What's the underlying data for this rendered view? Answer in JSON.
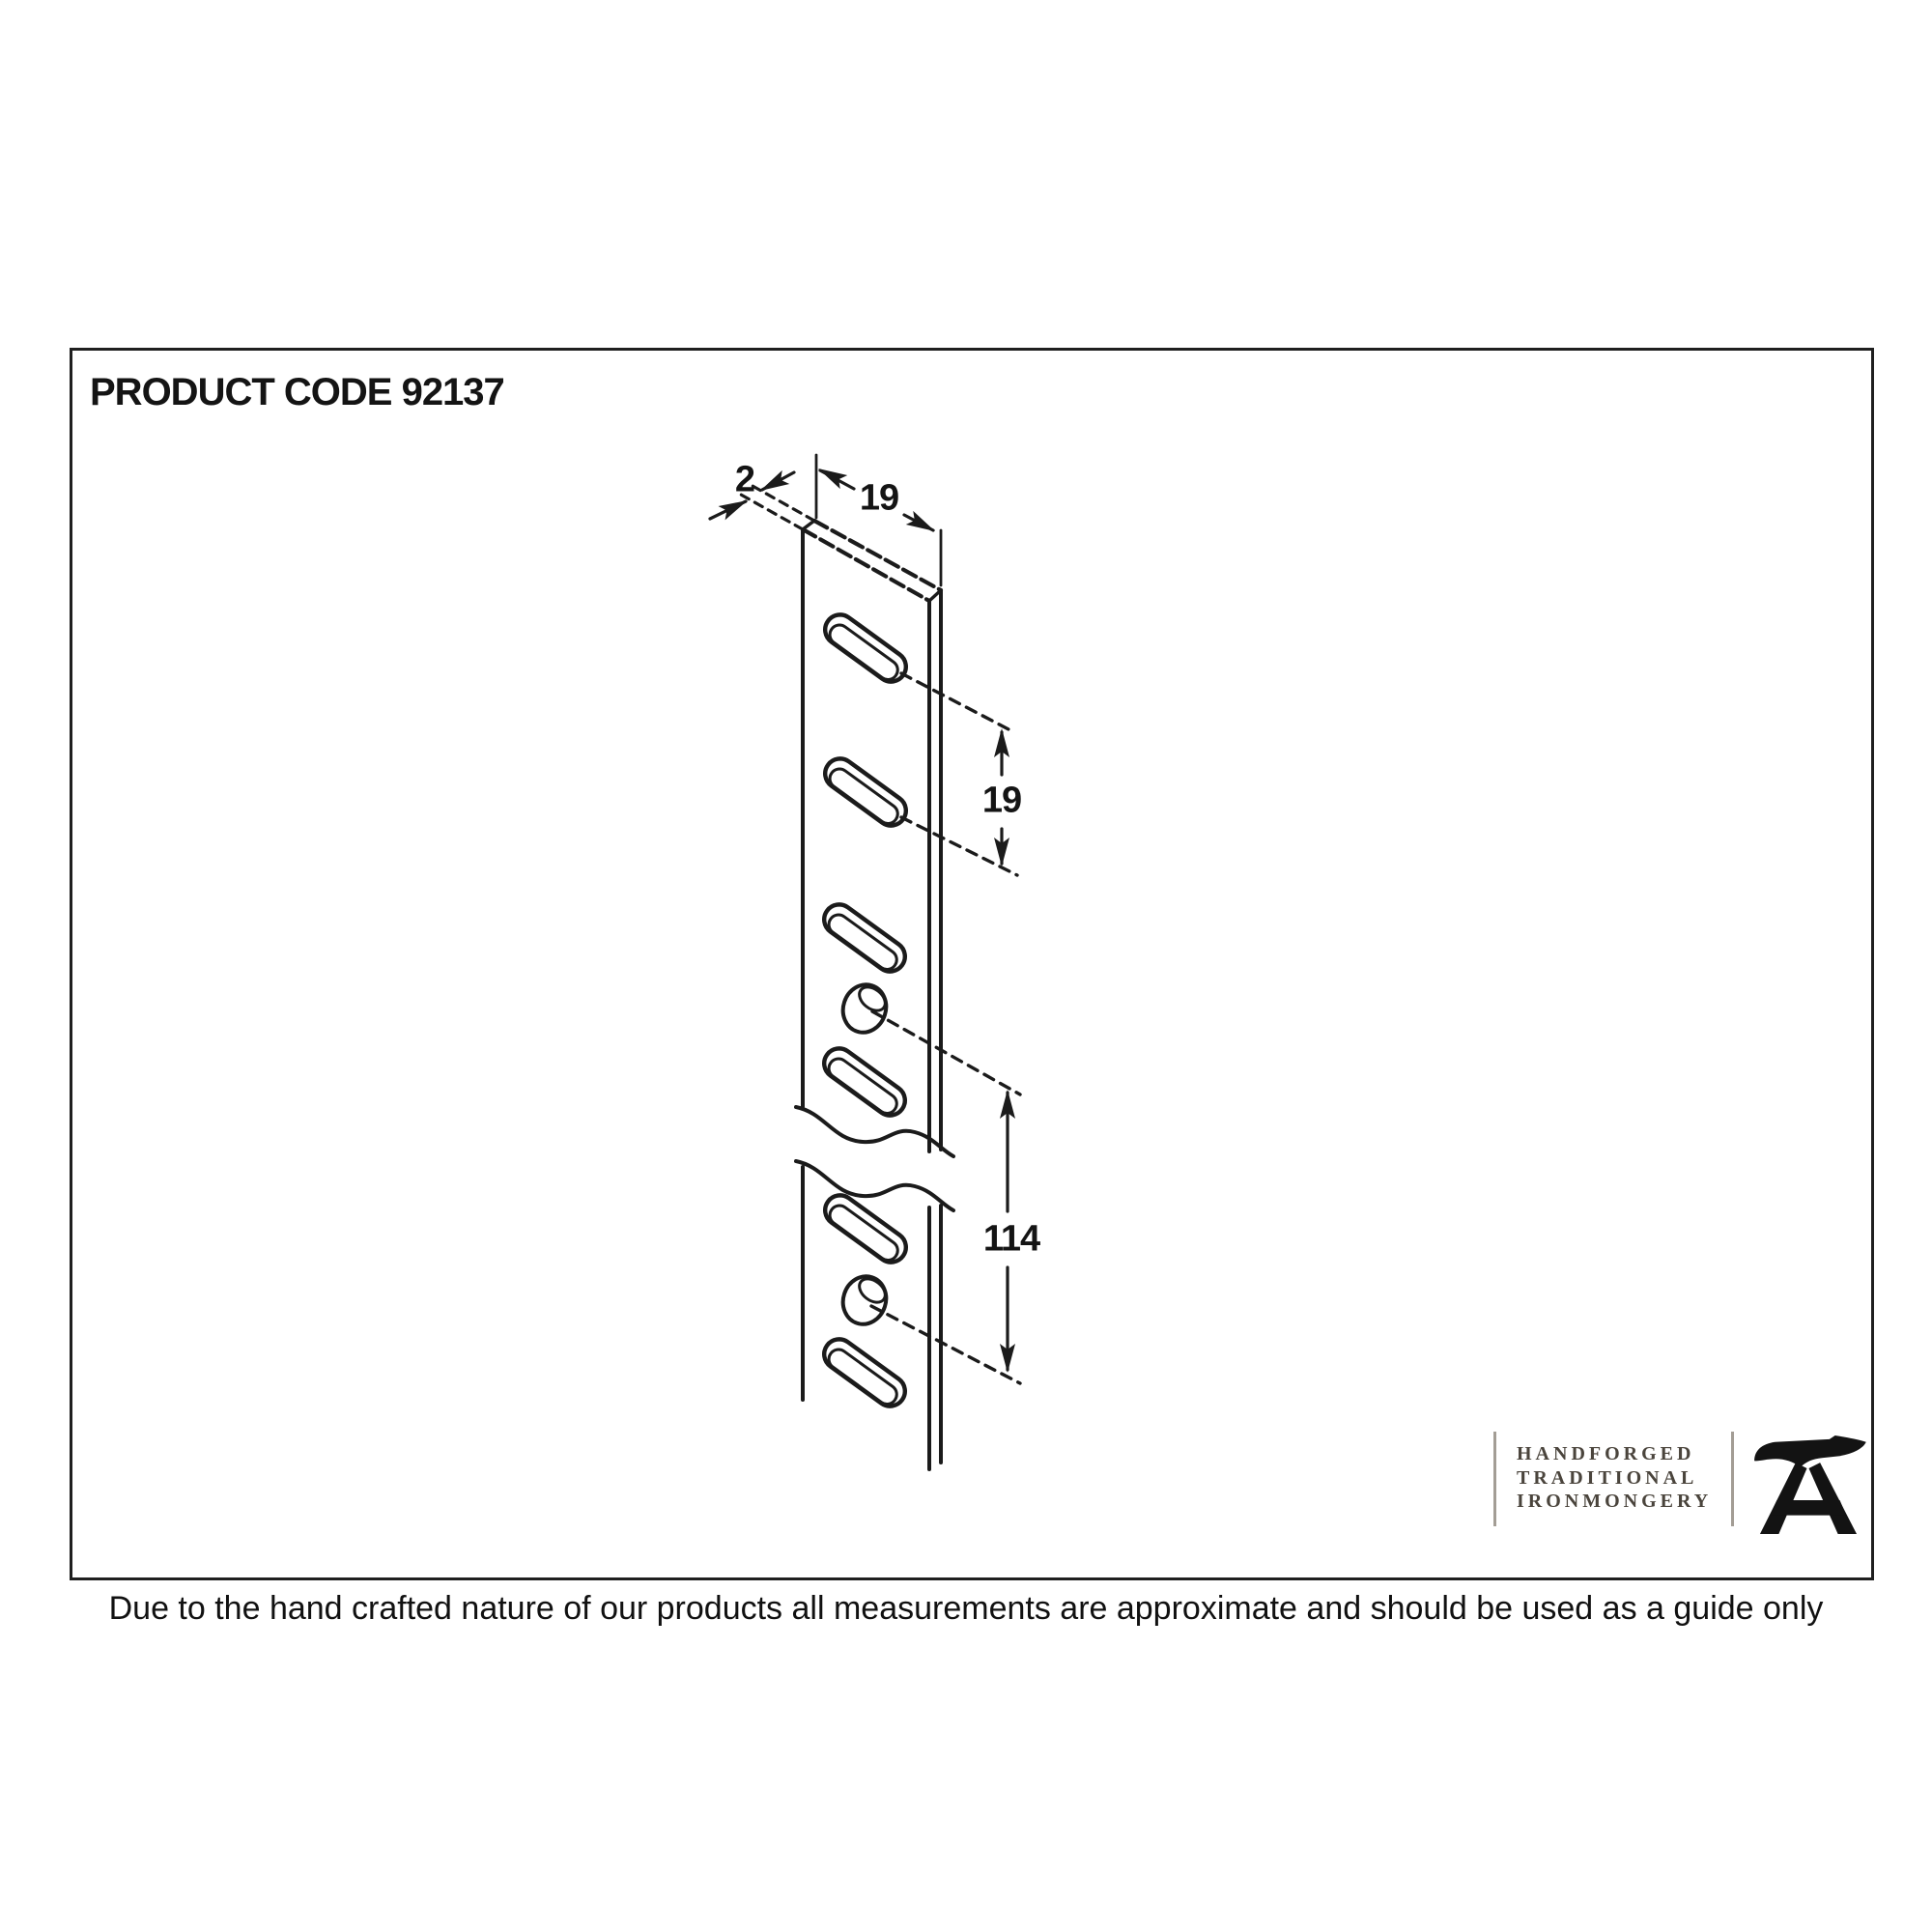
{
  "page": {
    "background": "#ffffff"
  },
  "header": {
    "product_code": "PRODUCT CODE 92137"
  },
  "diagram": {
    "dim_thickness": "2",
    "dim_width": "19",
    "dim_slot_spacing": "19",
    "dim_length": "114"
  },
  "logo": {
    "line1": "HANDFORGED",
    "line2": "TRADITIONAL",
    "line3": "IRONMONGERY",
    "icon": "anvil-icon"
  },
  "footer": {
    "disclaimer": "Due to the hand crafted nature of our products all measurements are approximate and should be used as a guide only"
  },
  "colors": {
    "ink": "#1b1b1b",
    "logo_text": "#4a443c",
    "logo_rule": "#a39d95"
  }
}
